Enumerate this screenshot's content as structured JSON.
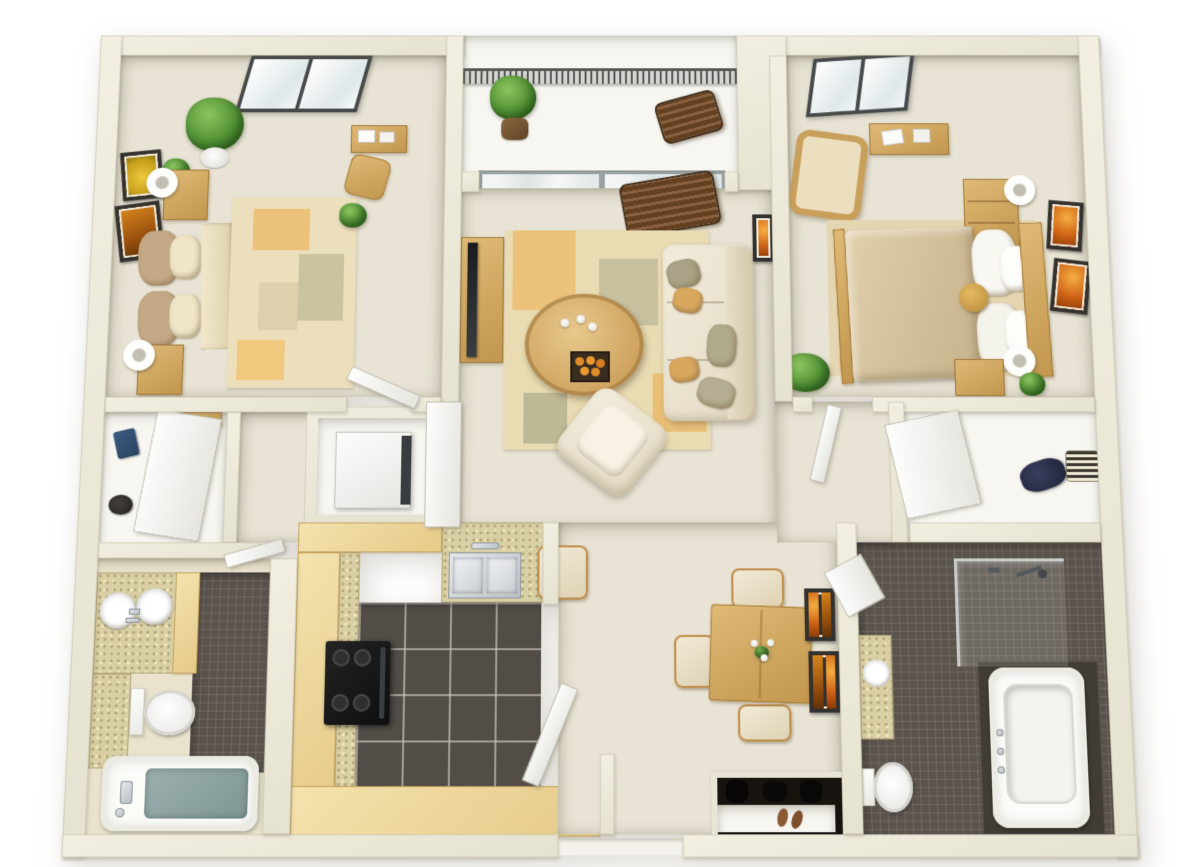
{
  "scene": {
    "type": "floor-plan-3d-render",
    "view": "top-down dollhouse",
    "layout": "two-bedroom two-bath apartment with balcony",
    "rooms": {
      "bedroom1": {
        "name": "Bedroom 1",
        "furniture": [
          "double bed with tan comforter",
          "two nightstands",
          "two white table lamps",
          "large potted plant",
          "two small potted plants",
          "two framed artworks",
          "skylight",
          "area rug with orange patches",
          "desk with papers",
          "desk chair"
        ]
      },
      "balcony": {
        "name": "Balcony",
        "furniture": [
          "mesh railing",
          "potted plant",
          "dark wood slat bench"
        ]
      },
      "living": {
        "name": "Living Room",
        "furniture": [
          "sliding glass door",
          "dark wood rocking chair",
          "tv stand with television",
          "patterned area rug",
          "oval coffee table with candles and fruit tray",
          "cream sofa with pillows",
          "cream armchair",
          "framed orange artwork",
          "corner potted plant"
        ]
      },
      "bedroom2": {
        "name": "Bedroom 2",
        "furniture": [
          "double bed with white pillows",
          "wicker armchair",
          "desk with papers",
          "dresser",
          "nightstand",
          "two white table lamps",
          "gold round pillow",
          "two framed artworks",
          "skylight",
          "small plant",
          "area rug"
        ]
      },
      "closet": {
        "name": "Closet",
        "furniture": [
          "folded jeans",
          "dark hat",
          "wood shelf",
          "white door"
        ]
      },
      "vestibule": {
        "name": "Vestibule Hall",
        "furniture": []
      },
      "laundry": {
        "name": "Laundry Nook",
        "furniture": [
          "washer appliance",
          "tall white door"
        ]
      },
      "bath1": {
        "name": "Bathroom 1",
        "furniture": [
          "double vanity with two round sinks",
          "wood vanity cabinet",
          "toilet",
          "bathtub with teal mat",
          "chrome tub fixture",
          "dark mosaic tile floor"
        ]
      },
      "kitchen": {
        "name": "Kitchen",
        "furniture": [
          "u-shaped maple cabinets",
          "speckled countertop",
          "stainless double sink with faucet",
          "black range with burners",
          "dark square tile floor"
        ]
      },
      "dining": {
        "name": "Dining Area",
        "furniture": [
          "square wood table with flower vase",
          "four cushioned chairs",
          "two double framed artworks",
          "shoe closet with coats and slippers"
        ]
      },
      "entry": {
        "name": "Entry",
        "furniture": [
          "open white entry door",
          "threshold"
        ]
      },
      "hall": {
        "name": "Hallway",
        "furniture": [
          "bedroom door",
          "bathroom door"
        ]
      },
      "walkin": {
        "name": "Walk-in Closet",
        "furniture": [
          "navy clothing pile",
          "striped storage basket",
          "white door"
        ]
      },
      "bath2": {
        "name": "Bathroom 2",
        "furniture": [
          "vanity counter with round sink",
          "toilet",
          "large bathtub on dark tile deck",
          "glass corner shower with chrome head",
          "dark mosaic tile floor"
        ]
      }
    },
    "palette": {
      "wall": "#ebe7d8",
      "carpet": "#e8e3d4",
      "white_floor": "#f7f6f1",
      "cabinet_wood": "#edd59d",
      "furniture_wood": "#d2a65e",
      "counter_speckle": "#d9cfa4",
      "tile_dark": "#544e48",
      "sofa_cream": "#efe8d6",
      "bed_tan": "#bb9c7c",
      "accent_orange": "#ecc27b",
      "art_orange": "#cf6316",
      "plant_green": "#4a8a30",
      "tub_mat_teal": "#8fa6a4",
      "stainless": "#c4cacf",
      "stove_black": "#151515"
    }
  }
}
